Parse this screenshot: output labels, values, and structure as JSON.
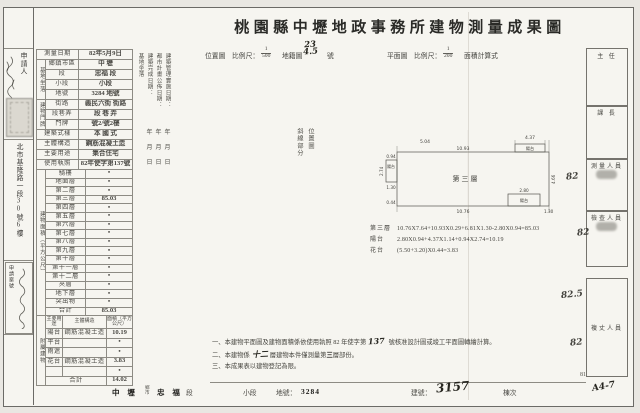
{
  "title": "桃園縣中壢地政事務所建物測量成果圖",
  "subheader": {
    "location_map": "位置圖",
    "scale_label_1": "比例尺：",
    "scale1_num": "1",
    "scale1_den": "500",
    "cadastral_map": "地籍圖",
    "sheet_no_top": "23",
    "sheet_no_bottom": "4.5",
    "sheet_no_suffix": "號",
    "floor_plan": "平面圖",
    "scale_label_2": "比例尺：",
    "scale2_num": "1",
    "scale2_den": "200",
    "area_formula": "面積計算式"
  },
  "left_strip": {
    "applicant_label": "申請人",
    "address": "北市基隆路一段30號6樓",
    "case_label": "申請案號"
  },
  "info_table": {
    "rows": [
      {
        "label": "測量日期",
        "value": "82年5月9日"
      },
      {
        "label": "鄉鎮市區",
        "value": "中 壢",
        "group": {
          "text": "基地坐落",
          "span": 4
        }
      },
      {
        "label": "段",
        "value": "忠福 段",
        "grouped": true
      },
      {
        "label": "小段",
        "value": "小段",
        "grouped": true
      },
      {
        "label": "地號",
        "value": "3284 地號",
        "grouped": true
      },
      {
        "label": "街路",
        "value": "義民六街 街路",
        "group": {
          "text": "建物門牌",
          "span": 3
        }
      },
      {
        "label": "段巷弄",
        "value": "段 巷 弄",
        "grouped": true
      },
      {
        "label": "門牌",
        "value": "號2/號2樓",
        "grouped": true
      },
      {
        "label": "建築式樣",
        "value": "本 國 式"
      },
      {
        "label": "主體構造",
        "value": "鋼筋混凝土造"
      },
      {
        "label": "主要用途",
        "value": "集合住宅"
      },
      {
        "label": "使用執照",
        "value": "82年使字第137號"
      }
    ]
  },
  "floor_section": {
    "group_label": "建物面積（平方公尺）",
    "rows": [
      [
        "騎樓",
        "•"
      ],
      [
        "地面層",
        "•"
      ],
      [
        "第二層",
        "•"
      ],
      [
        "第三層",
        "85.03"
      ],
      [
        "第四層",
        "•"
      ],
      [
        "第五層",
        "•"
      ],
      [
        "第六層",
        "•"
      ],
      [
        "第七層",
        "•"
      ],
      [
        "第八層",
        "•"
      ],
      [
        "第九層",
        "•"
      ],
      [
        "第十層",
        "•"
      ],
      [
        "第十一層",
        "•"
      ],
      [
        "第十二層",
        "•"
      ],
      [
        "夾層",
        "•"
      ],
      [
        "地下層",
        "•"
      ],
      [
        "突出物",
        "•"
      ],
      [
        "合計",
        "85.03"
      ]
    ]
  },
  "annex_section": {
    "group_label": "附屬建物",
    "headers": [
      "主要用途",
      "主體構造",
      "面積（平方公尺）"
    ],
    "rows": [
      [
        "陽台",
        "鋼筋混凝土造",
        "10.19"
      ],
      [
        "平台",
        "",
        "•"
      ],
      [
        "雨遮",
        "",
        "•"
      ],
      [
        "花台",
        "鋼筋混凝土造",
        "3.83"
      ],
      [
        "",
        "",
        "•"
      ],
      [
        "合計",
        "",
        "14.02"
      ]
    ]
  },
  "date_fields": [
    {
      "label": "基地坐落",
      "ymd": false
    },
    {
      "label": "建築完成日期：",
      "ymd": true
    },
    {
      "label": "都市計畫公佈日期：",
      "ymd": true
    },
    {
      "label": "建築管理實施日期：",
      "ymd": true
    }
  ],
  "location_note": {
    "col_right": "位置圖",
    "col_left": "斜線部分"
  },
  "plan": {
    "floor_label": "第三層",
    "balcony_top": "陽台",
    "balcony_left": "陽台",
    "balcony_bottom": "陽台",
    "dims": {
      "top_left": "5.04",
      "top": "10.93",
      "top_right": "4.37",
      "left_w": "0.94",
      "left_h": "2.74",
      "left_low": "1.30",
      "left_bottom": "0.44",
      "right": "4.66",
      "bottom": "10.76",
      "br_w": "2.80",
      "br_h": "1.30"
    }
  },
  "calculations": [
    {
      "label": "第三層",
      "formula": "10.76X7.64+10.93X0.29+6.81X1.30-2.80X0.94=85.03"
    },
    {
      "label": "陽台",
      "formula": "2.80X0.94+4.37X1.14+0.94X2.74=10.19"
    },
    {
      "label": "花台",
      "formula": "(5.50+3.20)X0.44=3.83"
    }
  ],
  "notes": [
    [
      {
        "t": "一、本建物平面圖及建物面積係依使用執照 82 年使字第"
      },
      {
        "t": "137",
        "hw": true
      },
      {
        "t": " 號核准設計圖或竣工平面圖轉繪計算。"
      }
    ],
    [
      {
        "t": "二、本建物係"
      },
      {
        "t": "十二",
        "hw": true
      },
      {
        "t": "層建物本件僅測量第"
      },
      {
        "t": "三",
        "b": true
      },
      {
        "t": "層部份。"
      }
    ],
    [
      {
        "t": "三、本成果表以建物登記為限。"
      }
    ]
  ],
  "footer": {
    "district": "中 壢",
    "township": "鄉",
    "city": "市",
    "section": "忠 福",
    "section_suffix": "段",
    "small_section": "小段",
    "land_no_label": "地號：",
    "land_no": "3284",
    "building_no_label": "建號：",
    "building_no": "3157",
    "unit_label": "棟次"
  },
  "signoff": {
    "boxes": [
      {
        "label": "主 任"
      },
      {
        "label": "課 長"
      },
      {
        "label": "測量人員",
        "stamp": true
      },
      {
        "label": "檢查人員",
        "stamp": true
      },
      {
        "label": "複丈人員"
      }
    ],
    "marks": [
      "82",
      "82",
      "82.5",
      "82"
    ],
    "page_number": "81",
    "page_mark": "A4-7"
  }
}
